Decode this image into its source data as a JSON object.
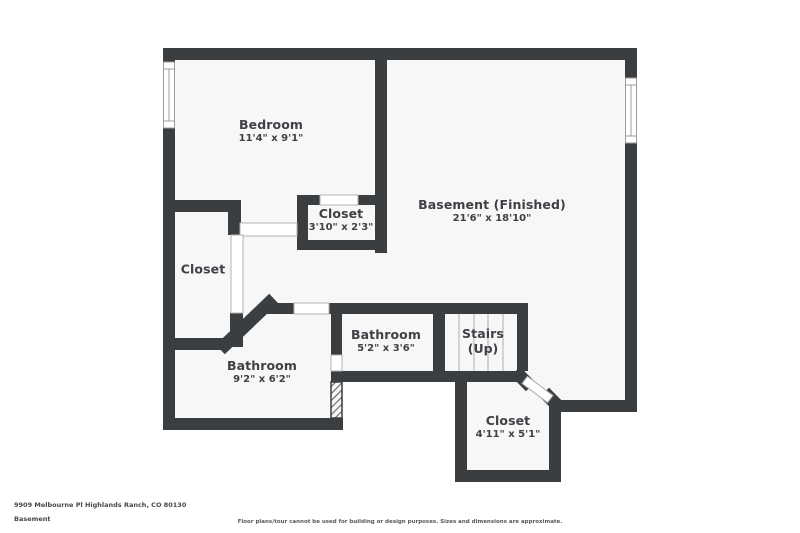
{
  "page": {
    "width": 800,
    "height": 533,
    "background": "#ffffff"
  },
  "colors": {
    "wall": "#3b3e41",
    "floor": "#f7f7f7",
    "label_text": "#3e4145",
    "stair_tread": "#c7c7c7",
    "opening_outline": "#b3b3b3"
  },
  "floorplan": {
    "rooms": [
      {
        "name": "Bedroom",
        "dims": "11'4\" x 9'1\""
      },
      {
        "name": "Closet",
        "dims": "3'10\" x 2'3\""
      },
      {
        "name": "Basement (Finished)",
        "dims": "21'6\" x 18'10\""
      },
      {
        "name": "Closet",
        "dims": ""
      },
      {
        "name": "Bathroom",
        "dims": "9'2\" x 6'2\""
      },
      {
        "name": "Bathroom",
        "dims": "5'2\" x 3'6\""
      },
      {
        "name": "Stairs",
        "dims": "(Up)"
      },
      {
        "name": "Closet",
        "dims": "4'11\" x 5'1\""
      }
    ]
  },
  "footer": {
    "address": "9909 Melbourne Pl Highlands Ranch, CO 80130",
    "floor_label": "Basement",
    "disclaimer": "Floor plans/tour cannot be used for building or design purposes. Sizes and dimensions are approximate."
  }
}
